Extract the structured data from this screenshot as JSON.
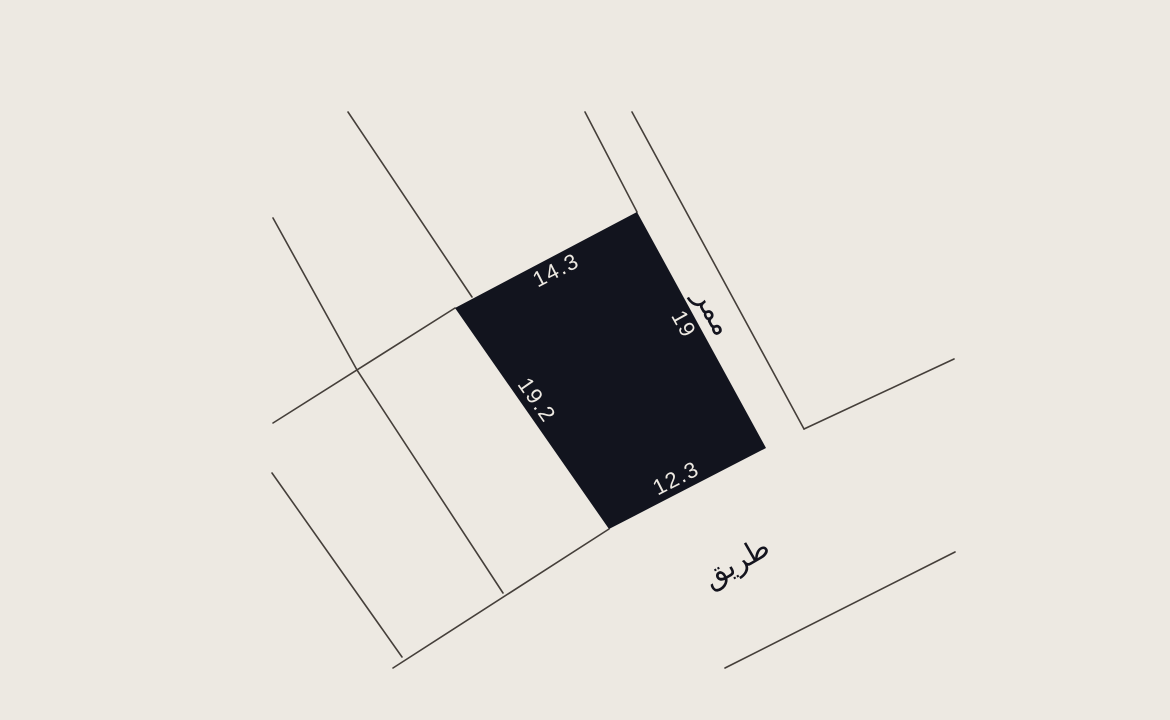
{
  "canvas": {
    "width": 1170,
    "height": 720,
    "background_color": "#EDE9E2"
  },
  "colors": {
    "parcel_fill": "#12141E",
    "boundary_line": "#453F3A",
    "dimension_text": "#EDE9E2",
    "street_text": "#14141E"
  },
  "parcel": {
    "description": "highlighted land plot",
    "polygon_points": "637,212 766,448 609,529 455,308",
    "dimensions": [
      {
        "label": "14.3",
        "side": "northwest",
        "x": 556,
        "y": 270,
        "rotation": -27
      },
      {
        "label": "19",
        "side": "northeast",
        "x": 684,
        "y": 324,
        "rotation": 61
      },
      {
        "label": "12.3",
        "side": "southeast",
        "x": 676,
        "y": 478,
        "rotation": -27
      },
      {
        "label": "19.2",
        "side": "southwest",
        "x": 537,
        "y": 400,
        "rotation": 55
      }
    ]
  },
  "streets": [
    {
      "label": "ممر",
      "meaning": "passage",
      "x": 714,
      "y": 312,
      "rotation": 61
    },
    {
      "label": "طريق",
      "meaning": "road",
      "x": 736,
      "y": 562,
      "rotation": -30
    }
  ],
  "boundary_lines": [
    {
      "name": "north-neighbor-boundary",
      "x1": 348,
      "y1": 112,
      "x2": 472,
      "y2": 297
    },
    {
      "name": "west-neighbor-boundary-upper",
      "x1": 273,
      "y1": 218,
      "x2": 357,
      "y2": 370
    },
    {
      "name": "west-neighbor-boundary-lower",
      "x1": 357,
      "y1": 370,
      "x2": 503,
      "y2": 593
    },
    {
      "name": "southwest-extension-of-parcel-edge",
      "x1": 455,
      "y1": 308,
      "x2": 273,
      "y2": 423
    },
    {
      "name": "far-west-neighbor-boundary",
      "x1": 272,
      "y1": 473,
      "x2": 402,
      "y2": 657
    },
    {
      "name": "south-road-edge",
      "x1": 393,
      "y1": 668,
      "x2": 609,
      "y2": 529
    },
    {
      "name": "passage-inner-edge",
      "x1": 585,
      "y1": 112,
      "x2": 637,
      "y2": 212
    },
    {
      "name": "passage-outer-edge",
      "x1": 632,
      "y1": 112,
      "x2": 804,
      "y2": 429
    },
    {
      "name": "northeast-neighbor-boundary",
      "x1": 804,
      "y1": 429,
      "x2": 954,
      "y2": 359
    },
    {
      "name": "southeast-road-edge",
      "x1": 725,
      "y1": 668,
      "x2": 955,
      "y2": 552
    }
  ]
}
